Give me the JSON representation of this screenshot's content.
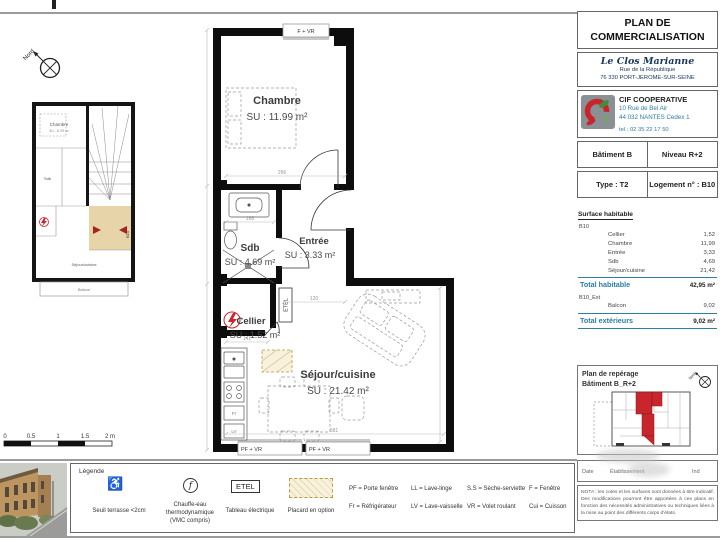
{
  "plan": {
    "north_label": "Nord",
    "rooms": {
      "chambre_name": "Chambre",
      "chambre_su": "SU : 11.99 m²",
      "sdb_name": "Sdb",
      "sdb_su": "SU : 4.69 m²",
      "entree_name": "Entrée",
      "entree_su": "SU : 3.33 m²",
      "cellier_name": "Cellier",
      "cellier_su": "SU : 1.52 m²",
      "sejour_name": "Séjour/cuisine",
      "sejour_su": "SU : 21.42 m²"
    },
    "windows": {
      "top": "F + VR",
      "bottom_left": "PF + VR",
      "bottom_right": "PF + VR"
    },
    "etel_label": "ETEL",
    "kitchen": {
      "fr": "Fr",
      "lv": "LV"
    },
    "dims": {
      "chambre_w": "296",
      "sdb_w": "168",
      "entree_w": "120",
      "cellier_w": "141",
      "sejour_w": "581"
    }
  },
  "mini_plan": {
    "chambre": "Chambre",
    "chambre_su": "SU : 11.99 m²",
    "sdb": "Sdb",
    "sejour": "Séjour/cuisine",
    "balcon": "Balcon",
    "unit": "B10"
  },
  "scale_bar": {
    "t0": "0",
    "t1": "0.5",
    "t2": "1",
    "t3": "1.5",
    "t4": "2 m"
  },
  "title_block": {
    "title_line1": "PLAN DE",
    "title_line2": "COMMERCIALISATION",
    "project_name": "Le Clos Marianne",
    "project_addr1": "Rue de la République",
    "project_addr2": "76 330 PORT-JEROME-SUR-SEINE",
    "company_name": "CIF COOPERATIVE",
    "company_addr1": "10 Rue de Bel Air",
    "company_addr2": "44 032 NANTES Cedex 1",
    "company_tel": "tel : 02 35 22 17 50",
    "building": "Bâtiment B",
    "level": "Niveau R+2",
    "type": "Type : T2",
    "unit": "Logement n° : B10",
    "surface": {
      "header": "Surface habitable",
      "group1": "B10",
      "rows": [
        {
          "label": "Cellier",
          "value": "1,52"
        },
        {
          "label": "Chambre",
          "value": "11,99"
        },
        {
          "label": "Entrée",
          "value": "3,33"
        },
        {
          "label": "Sdb",
          "value": "4,69"
        },
        {
          "label": "Séjour/cuisine",
          "value": "21,42"
        }
      ],
      "total_label": "Total habitable",
      "total_val": "42,95 m²",
      "group2": "B10_Ext",
      "ext_rows": [
        {
          "label": "Balcon",
          "value": "9,02"
        }
      ],
      "ext_total_label": "Total extérieurs",
      "ext_total_val": "9,02 m²"
    }
  },
  "reperage": {
    "line1": "Plan de repérage",
    "line2": "Bâtiment B_R+2",
    "north_label": "Nord"
  },
  "footer": {
    "date_label": "Date",
    "etab_label": "Établissement",
    "ind_label": "Ind",
    "nota": "NOTA : les cotes et les surfaces sont données à titre indicatif. Des modifications pourront être apportées à ces plans en fonction des nécessités administratives ou techniques liées à la mise au point des différents corps d'états."
  },
  "legend": {
    "title": "Légende",
    "items": [
      {
        "icon": "wheelchair-icon",
        "label": "Seuil terrasse <2cm"
      },
      {
        "icon": "chauffe-eau-icon",
        "label_line1": "Chauffe-eau",
        "label_line2": "thermodynamique",
        "label_line3": "(VMC compris)"
      },
      {
        "icon": "etel-box",
        "box_text": "ETEL",
        "label": "Tableau électrique"
      },
      {
        "icon": "placard-swatch",
        "label": "Placard en option"
      }
    ],
    "abbr": [
      {
        "l1": "PF = Porte fenêtre",
        "l2": "Fr = Réfrigérateur"
      },
      {
        "l1": "LL = Lave-linge",
        "l2": "LV = Lave-vaisselle"
      },
      {
        "l1": "S.S = Sèche-serviette",
        "l2": "VR = Volet roulant"
      },
      {
        "l1": "F = Fenêtre",
        "l2": "Cui = Cuisson"
      }
    ]
  }
}
